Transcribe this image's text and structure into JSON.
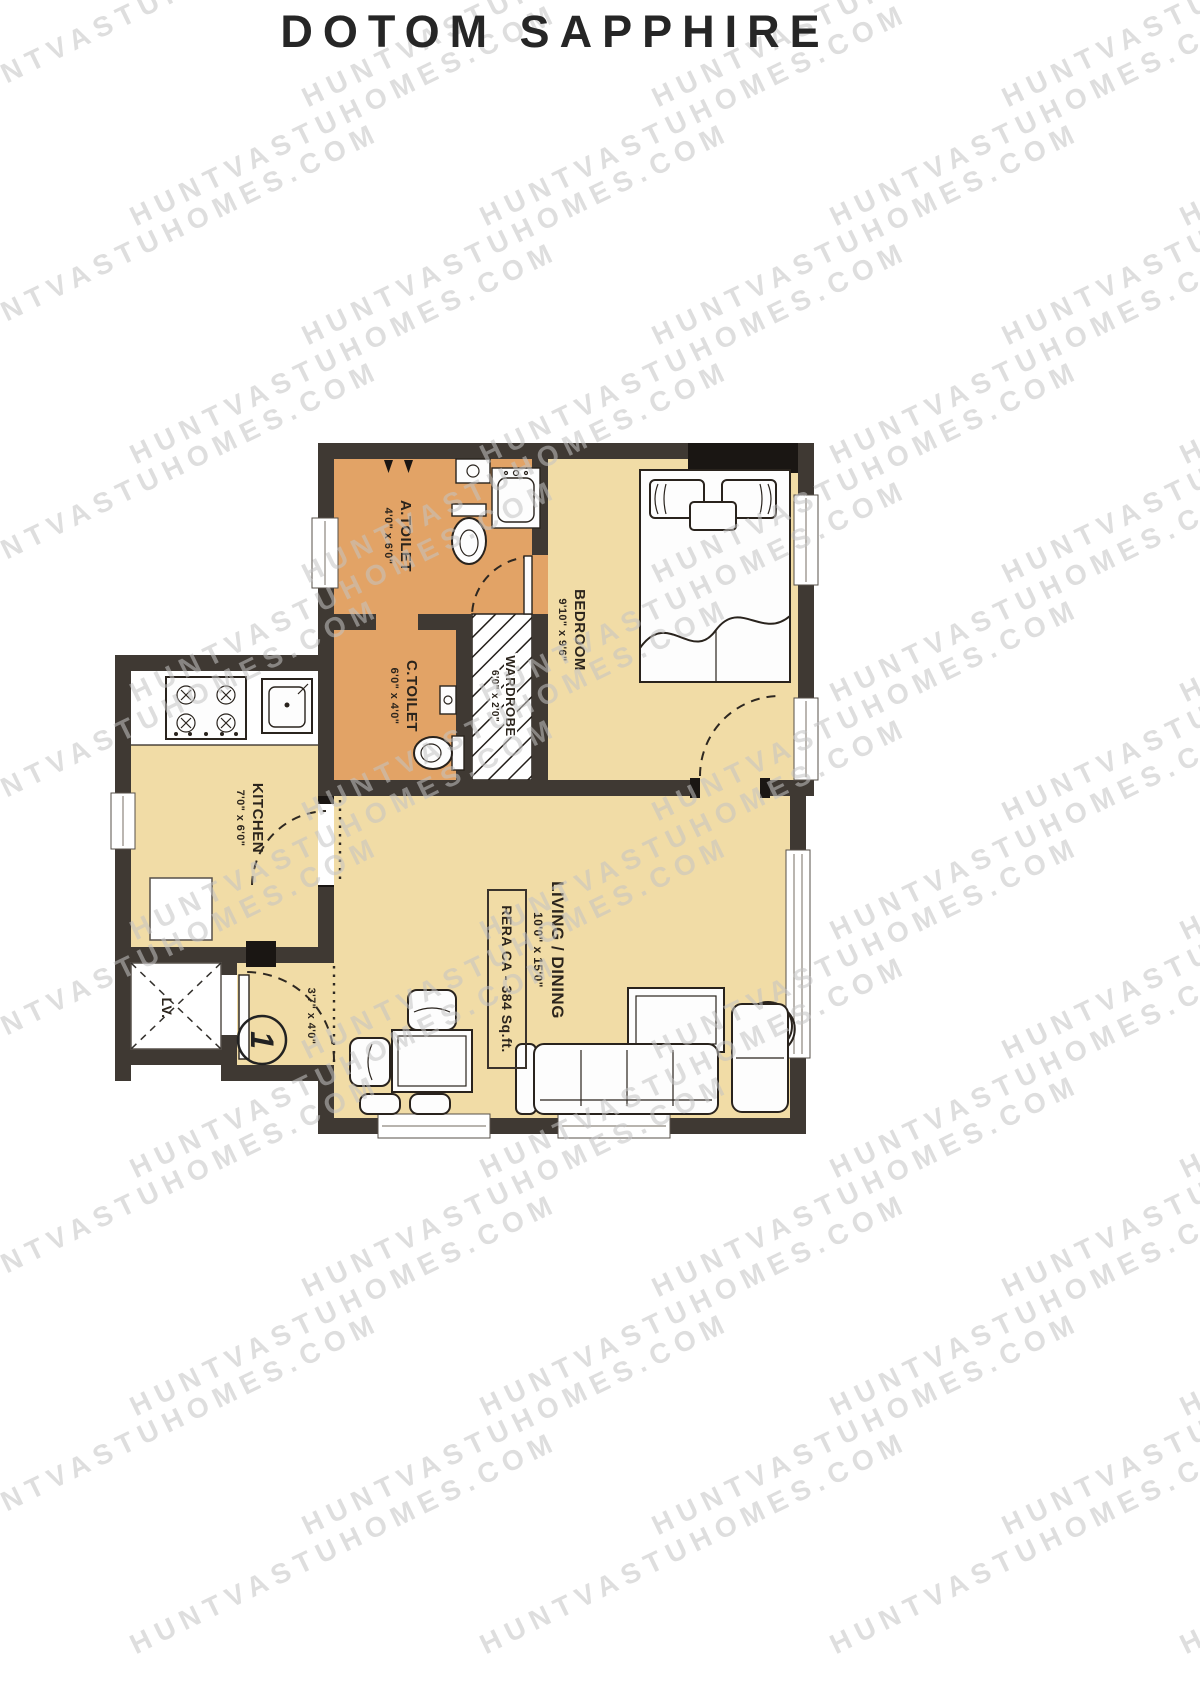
{
  "title": "DOTOM SAPPHIRE",
  "watermark": {
    "text": "HUNTVASTUHOMES.COM"
  },
  "plan": {
    "unit_number": "1",
    "rera_label": "RERA CA - 384 Sq.ft.",
    "rooms": {
      "a_toilet": {
        "name": "A.TOILET",
        "dims": "4'0\" x 6'0\""
      },
      "c_toilet": {
        "name": "C.TOILET",
        "dims": "6'0\" x 4'0\""
      },
      "wardrobe": {
        "name": "WARDROBE",
        "dims": "6'0\" x 2'0\""
      },
      "bedroom": {
        "name": "BEDROOM",
        "dims": "9'10\" x 9'6\""
      },
      "kitchen": {
        "name": "KITCHEN",
        "dims": "7'0\" x 6'0\""
      },
      "living": {
        "name": "LIVING / DINING",
        "dims": "10'0\" x 15'0\""
      },
      "foyer": {
        "dims": "3'7\" x 4'0\""
      },
      "lift": {
        "name": "LV."
      }
    },
    "colors": {
      "wall": "#3f3933",
      "floor": "#f1dca6",
      "tfloor": "#e2a366",
      "outline": "#29231d"
    }
  }
}
